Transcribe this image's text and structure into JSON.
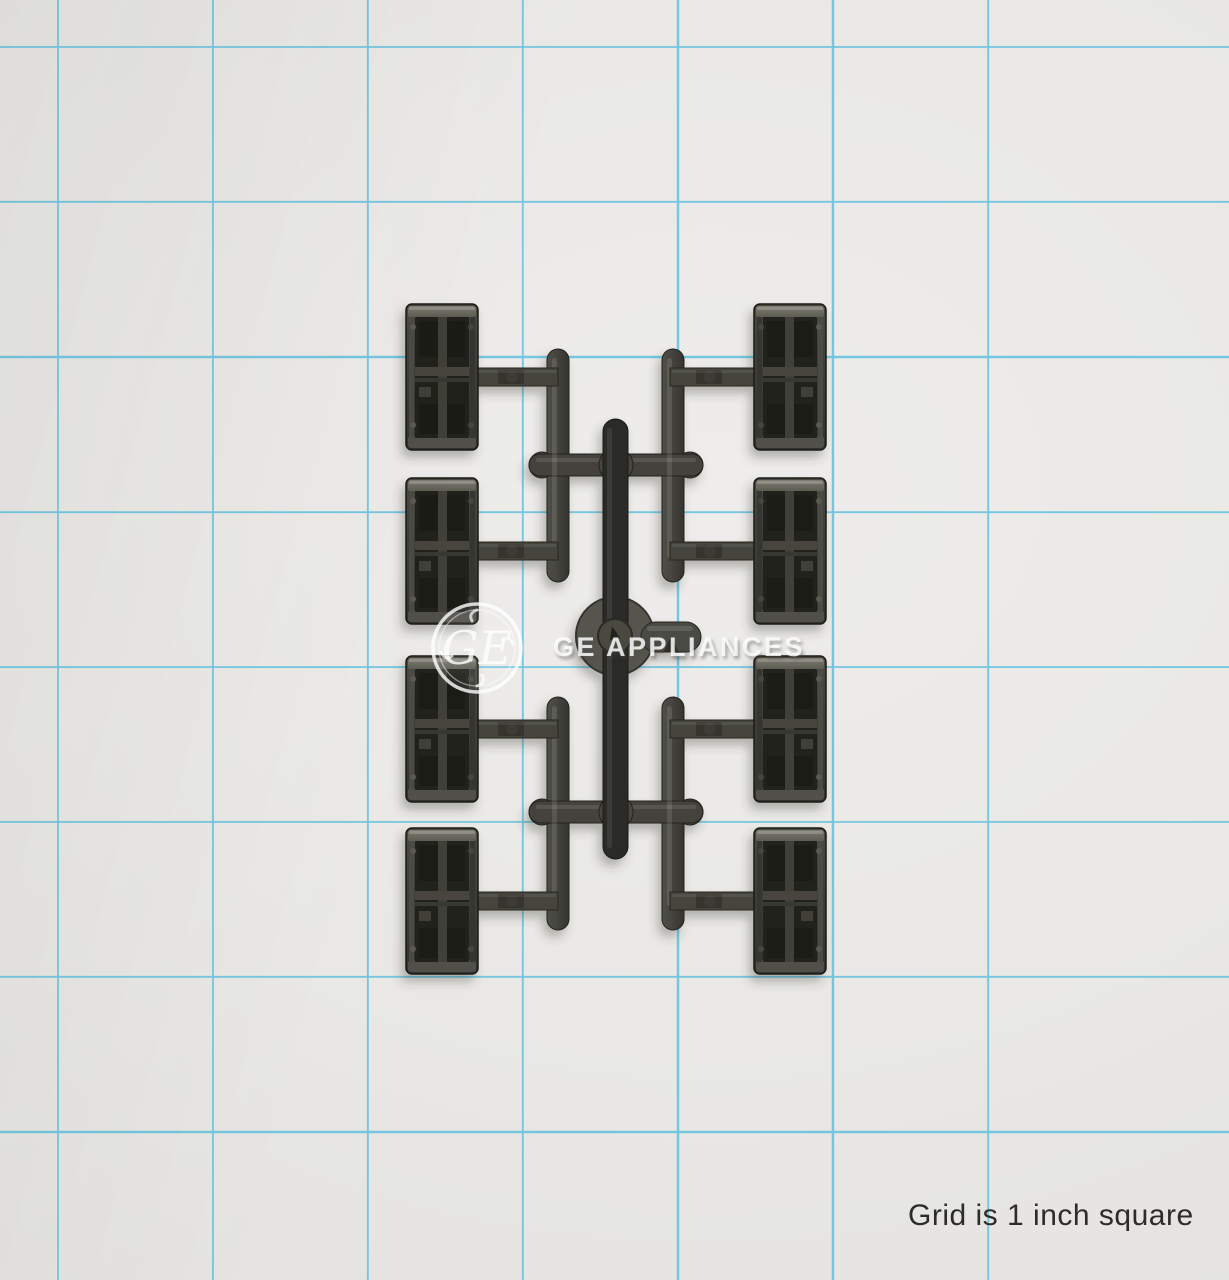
{
  "photo": {
    "caption": "Grid is 1 inch square",
    "watermark": {
      "brand_text": "GE APPLIANCES",
      "monogram_text": "GE"
    },
    "subject": {
      "parts_count": "8",
      "description": "Dark gray molded plastic clips on an injection-molding sprue runner, laid on blue 1-inch grid paper"
    },
    "colors": {
      "paper": "#e9e8e5",
      "grid_line": "#58bedf",
      "plastic_dark": "#3c3b36",
      "plastic_runner": "#45443e",
      "caption_text": "#2d2c2a",
      "watermark_white": "rgba(255,255,255,0.78)"
    }
  }
}
